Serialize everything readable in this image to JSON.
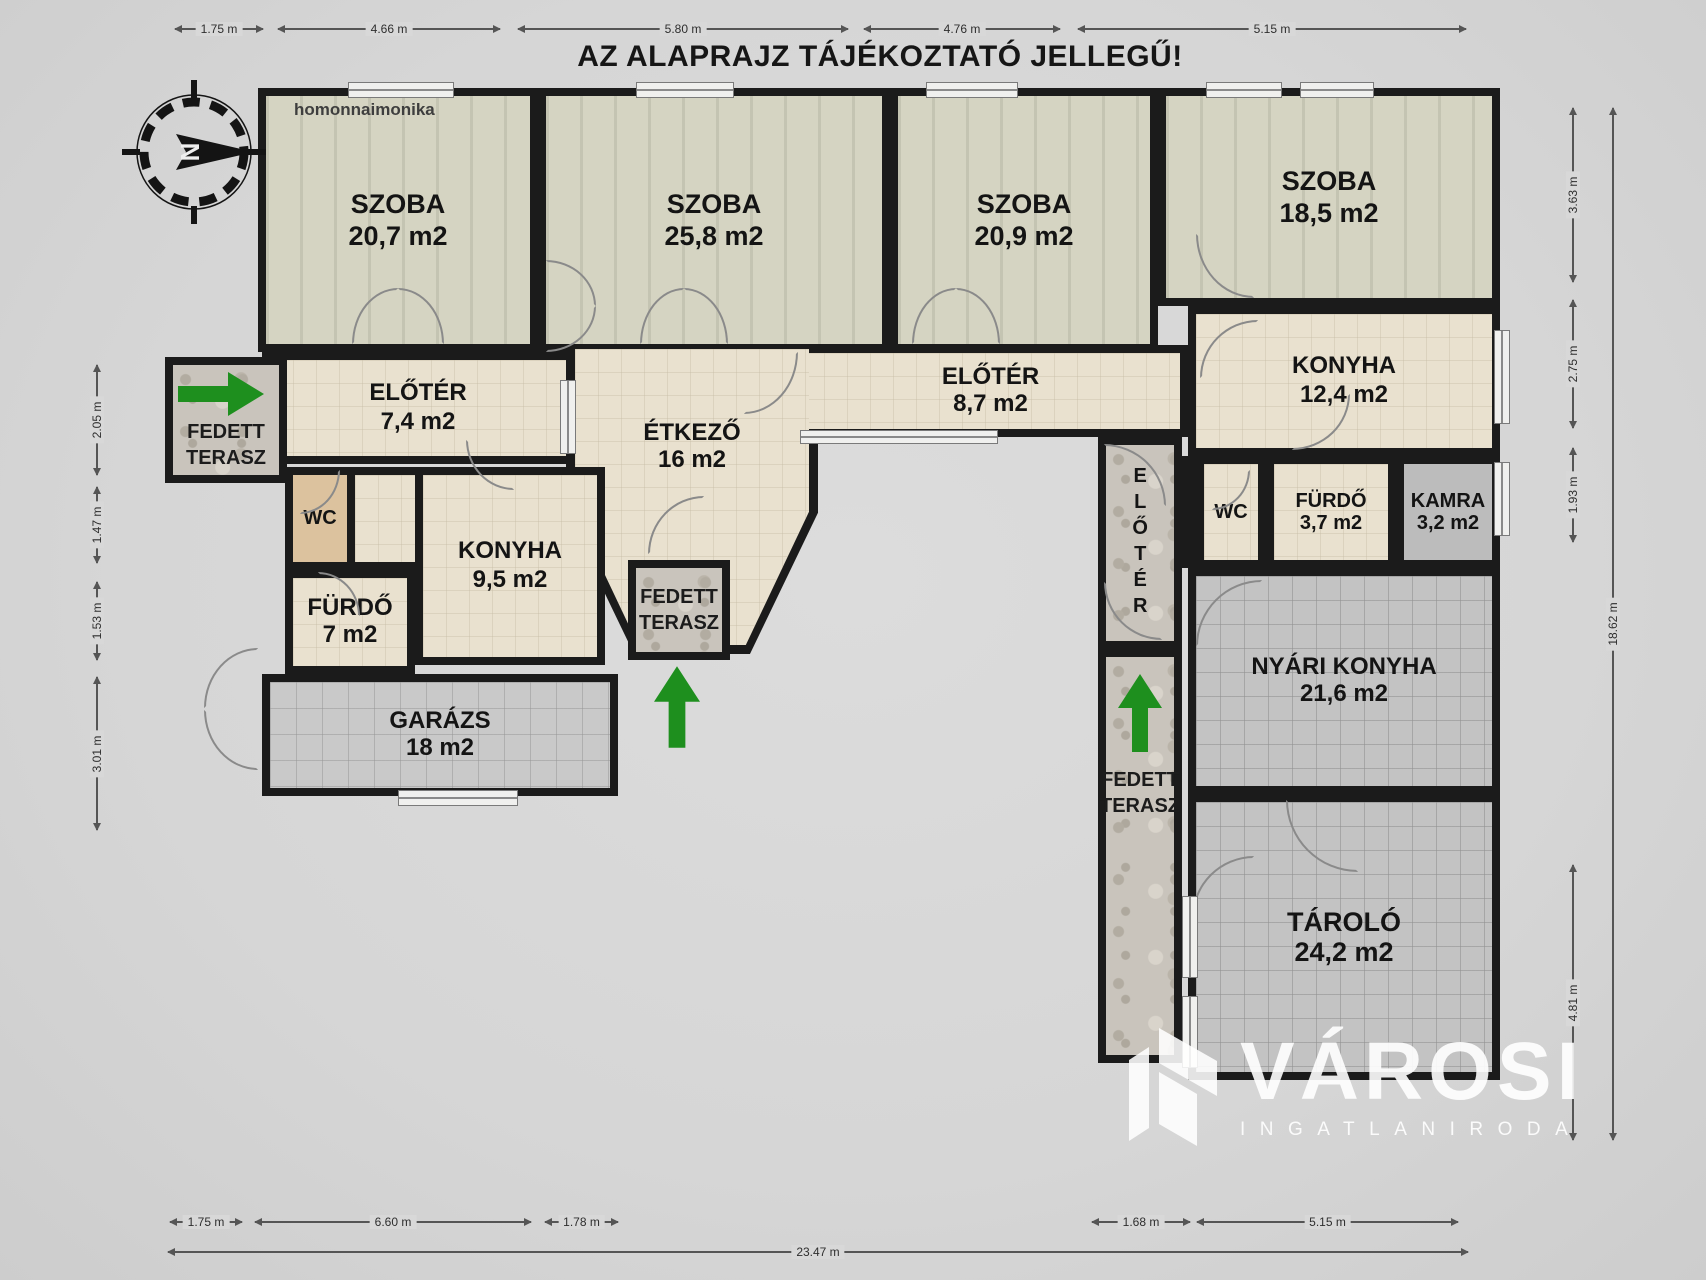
{
  "title": "AZ ALAPRAJZ TÁJÉKOZTATÓ JELLEGŰ!",
  "watermark": "homonnaimonika",
  "compass": {
    "north": "N"
  },
  "rooms": {
    "szoba1": {
      "name": "SZOBA",
      "area": "20,7 m2"
    },
    "szoba2": {
      "name": "SZOBA",
      "area": "25,8 m2"
    },
    "szoba3": {
      "name": "SZOBA",
      "area": "20,9 m2"
    },
    "szoba4": {
      "name": "SZOBA",
      "area": "18,5 m2"
    },
    "eloter74": {
      "name": "ELŐTÉR",
      "area": "7,4 m2"
    },
    "etkezo": {
      "name": "ÉTKEZŐ",
      "area": "16 m2"
    },
    "eloter87": {
      "name": "ELŐTÉR",
      "area": "8,7 m2"
    },
    "konyha124": {
      "name": "KONYHA",
      "area": "12,4 m2"
    },
    "wc_left": {
      "name": "WC",
      "area": ""
    },
    "konyha95": {
      "name": "KONYHA",
      "area": "9,5 m2"
    },
    "furdo7": {
      "name": "FÜRDŐ",
      "area": "7 m2"
    },
    "garazs": {
      "name": "GARÁZS",
      "area": "18 m2"
    },
    "wc_right": {
      "name": "WC",
      "area": ""
    },
    "furdo37": {
      "name": "FÜRDŐ",
      "area": "3,7 m2"
    },
    "kamra": {
      "name": "KAMRA",
      "area": "3,2 m2"
    },
    "nyari_konyha": {
      "name": "NYÁRI KONYHA",
      "area": "21,6 m2"
    },
    "tarolo": {
      "name": "TÁROLÓ",
      "area": "24,2 m2"
    },
    "terasz_left": {
      "name": "FEDETT TERASZ",
      "area": ""
    },
    "terasz_mid": {
      "name": "FEDETT TERASZ",
      "area": ""
    },
    "terasz_right": {
      "name": "FEDETT TERASZ",
      "area": ""
    },
    "eloter_folyoso": {
      "name": "ELŐTÉR",
      "area": ""
    }
  },
  "dimensions": {
    "top": [
      "1.75 m",
      "4.66 m",
      "5.80 m",
      "4.76 m",
      "5.15 m"
    ],
    "left": [
      "2.05 m",
      "1.47 m",
      "1.53 m",
      "3.01 m"
    ],
    "right": [
      "3.63 m",
      "2.75 m",
      "1.93 m",
      "4.81 m"
    ],
    "right_total": "18.62 m",
    "bottom": [
      "1.75 m",
      "6.60 m",
      "1.78 m",
      "1.68 m",
      "5.15 m"
    ],
    "bottom_total": "23.47 m"
  },
  "logo": {
    "brand": "VÁROSI",
    "tagline": "INGATLANIRODA"
  }
}
